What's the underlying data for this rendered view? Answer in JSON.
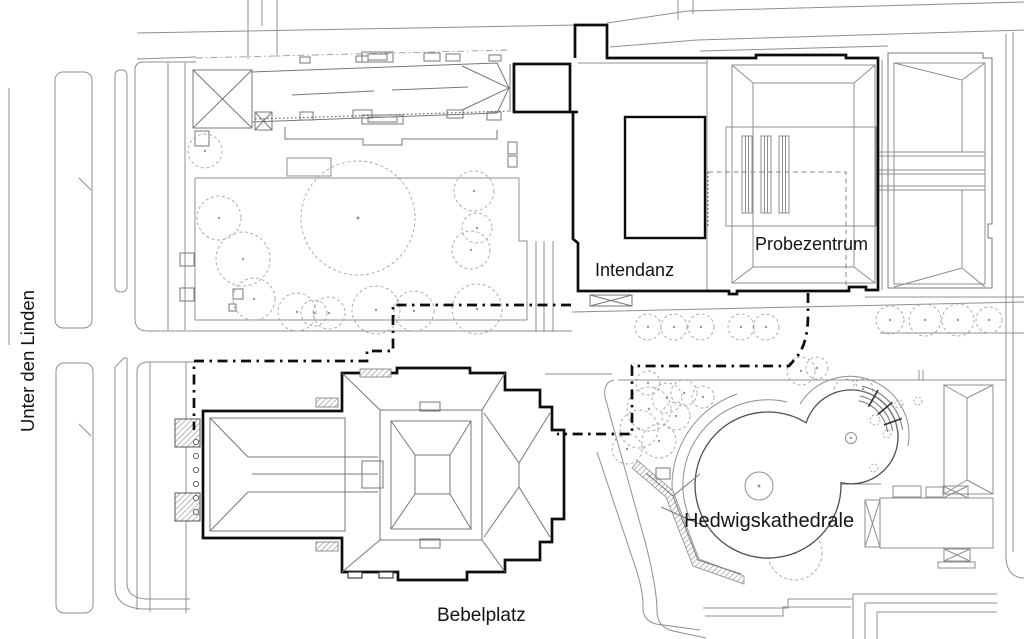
{
  "map": {
    "labels": {
      "street": "Unter den Linden",
      "intendanz": "Intendanz",
      "probezentrum": "Probezentrum",
      "kathedrale": "Hedwigskathedrale",
      "platz": "Bebelplatz"
    },
    "colors": {
      "background": "#ffffff",
      "thin_line": "#8f8f8f",
      "medium_line": "#4f4f4f",
      "bold_line": "#0c0c0c",
      "tree_line": "#a5a5a5",
      "text": "#141414"
    }
  }
}
